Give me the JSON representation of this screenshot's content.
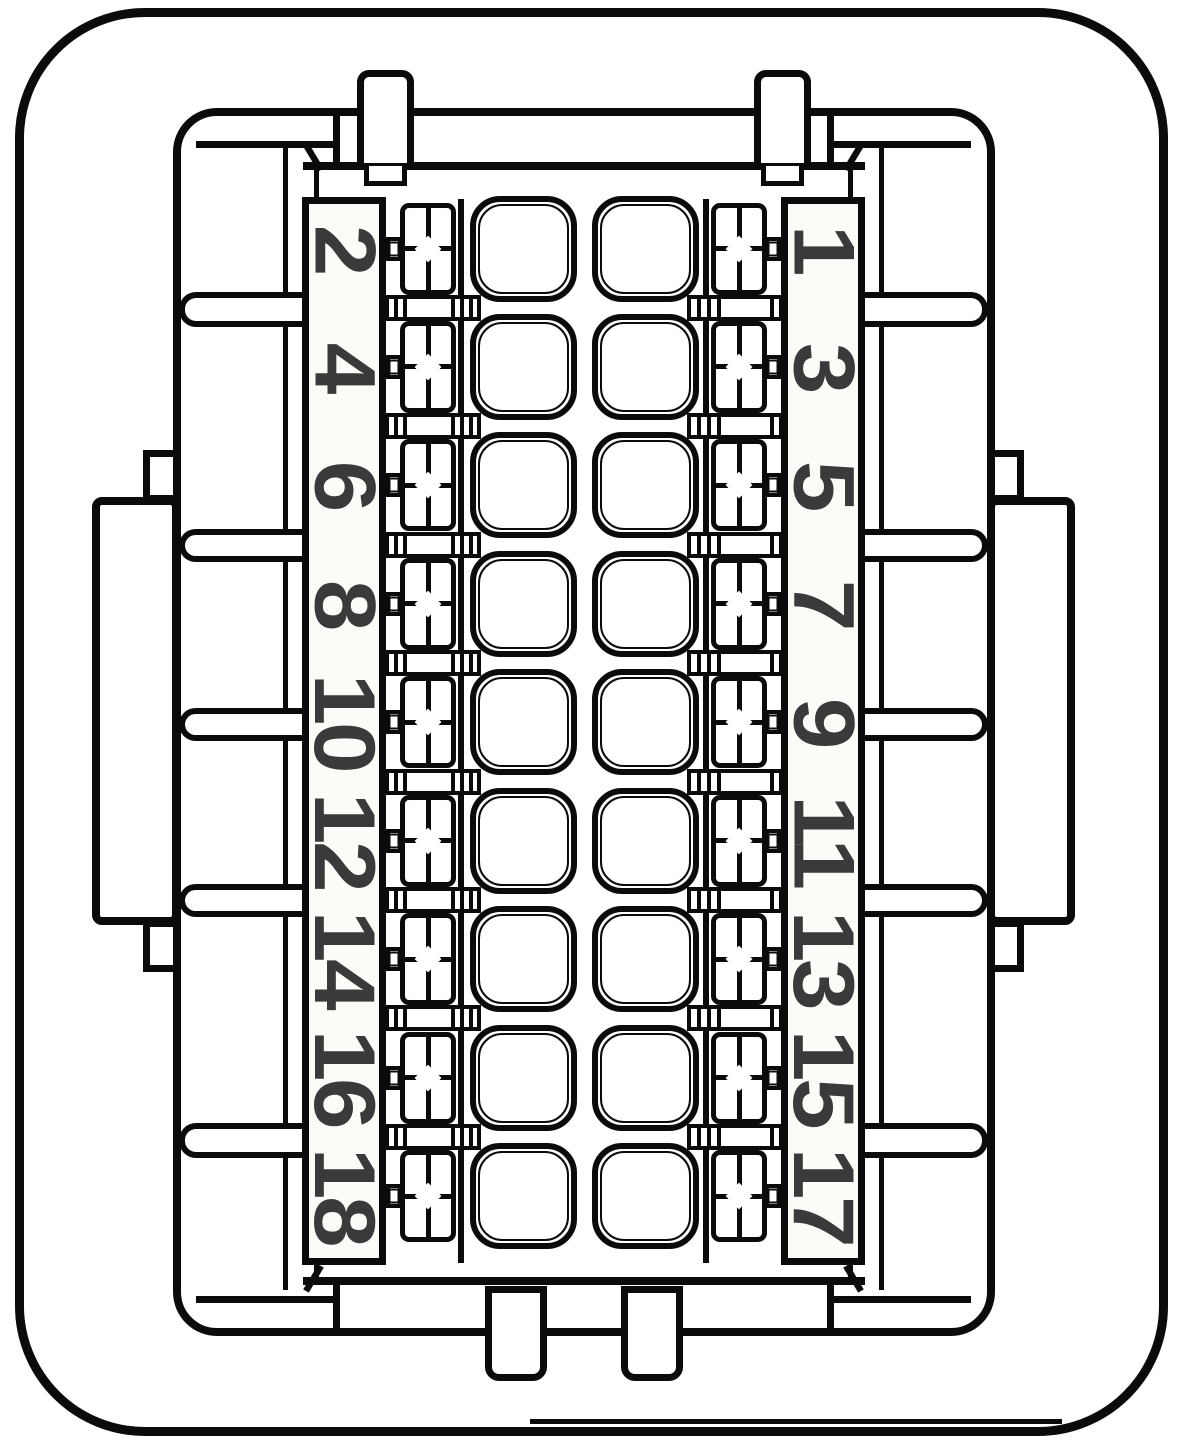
{
  "diagram": {
    "kind": "connector-pinout-face-view",
    "rows": 9,
    "columns": 2,
    "pins": {
      "left": [
        "2",
        "4",
        "6",
        "8",
        "10",
        "12",
        "14",
        "16",
        "18"
      ],
      "right": [
        "1",
        "3",
        "5",
        "7",
        "9",
        "11",
        "13",
        "15",
        "17"
      ]
    },
    "colors": {
      "line": "#0b0b0b",
      "digit": "#3a3a3a",
      "background": "#ffffff"
    }
  }
}
